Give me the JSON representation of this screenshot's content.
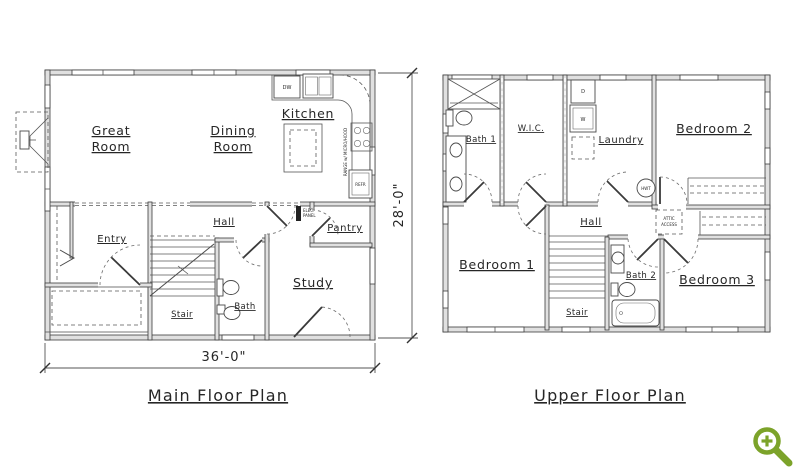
{
  "page": {
    "background": "#ffffff",
    "ink_color": "#262626",
    "wall_fill": "#e0e0e0",
    "line_color": "#4a4a4a"
  },
  "main_floor": {
    "title": "Main Floor Plan",
    "dim_width": "36'-0\"",
    "dim_height": "28'-0\"",
    "labels": {
      "great_room_1": "Great",
      "great_room_2": "Room",
      "dining_room_1": "Dining",
      "dining_room_2": "Room",
      "kitchen": "Kitchen",
      "entry": "Entry",
      "hall": "Hall",
      "pantry": "Pantry",
      "study": "Study",
      "stair": "Stair",
      "bath": "Bath",
      "dw": "DW",
      "refr": "REFR",
      "range": "RANGE w/ MICRO/HOOD",
      "elec_1": "ELEC.",
      "elec_2": "PANEL"
    }
  },
  "upper_floor": {
    "title": "Upper Floor Plan",
    "labels": {
      "bath1": "Bath 1",
      "wic": "W.I.C.",
      "laundry": "Laundry",
      "bedroom2": "Bedroom 2",
      "hall": "Hall",
      "bedroom1": "Bedroom 1",
      "stair": "Stair",
      "bath2": "Bath 2",
      "bedroom3": "Bedroom 3",
      "attic_1": "ATTIC",
      "attic_2": "ACCESS",
      "hwt": "HWT",
      "dryer": "D",
      "washer": "W"
    }
  },
  "controls": {
    "zoom_button": "zoom-in",
    "zoom_button_color": "#7ca32a"
  }
}
